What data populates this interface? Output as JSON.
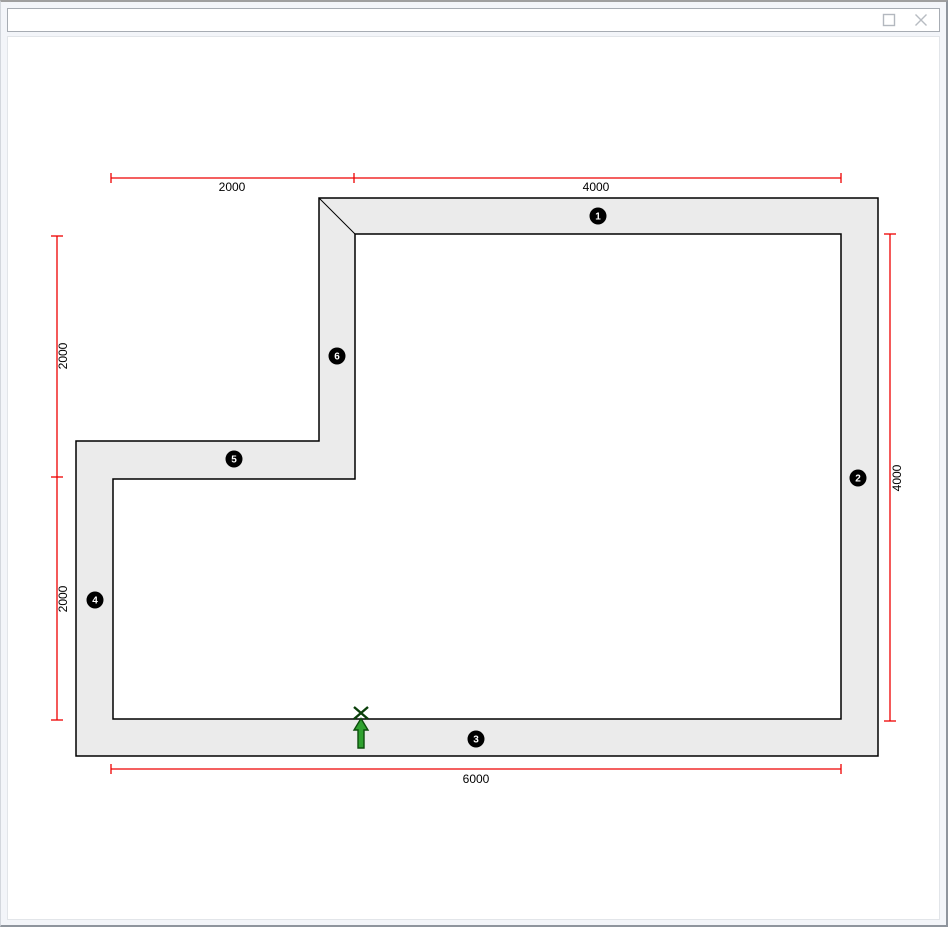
{
  "window": {
    "title": "",
    "controls": {
      "maximize_icon": "maximize-icon",
      "close_icon": "close-icon"
    }
  },
  "plan": {
    "type": "floor-plan",
    "wall_markers": [
      {
        "label": "1"
      },
      {
        "label": "2"
      },
      {
        "label": "3"
      },
      {
        "label": "4"
      },
      {
        "label": "5"
      },
      {
        "label": "6"
      }
    ],
    "dimensions": {
      "top": [
        "2000",
        "4000"
      ],
      "left": [
        "2000",
        "2000"
      ],
      "right": [
        "4000"
      ],
      "bottom": [
        "6000"
      ]
    },
    "insertion_marker": {
      "type": "up-arrow-with-x",
      "description": "green insertion arrow pointing at bottom wall inner edge"
    },
    "colors": {
      "dimension_line": "#ee0000",
      "wall_fill": "#ebebeb",
      "wall_stroke": "#000000",
      "marker_bg": "#000000",
      "marker_text": "#ffffff",
      "arrow_fill": "#2fa12f",
      "arrow_outline": "#0b4d0b"
    }
  }
}
